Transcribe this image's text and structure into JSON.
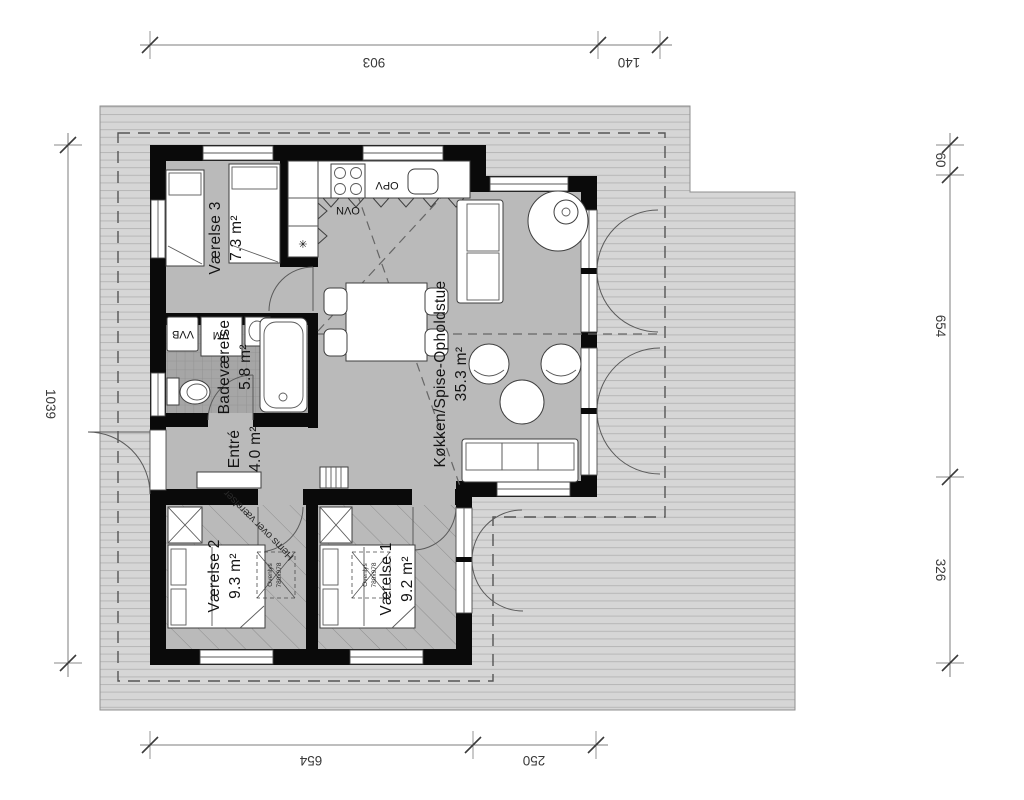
{
  "drawing": {
    "type": "floor-plan",
    "rooms": [
      {
        "name": "Værelse 3",
        "area": "7.3 m²"
      },
      {
        "name": "Badeværelse",
        "area": "5.8 m²"
      },
      {
        "name": "Entré",
        "area": "4.0 m²"
      },
      {
        "name": "Køkken/Spise-Opholdstue",
        "area": "35.3 m²"
      },
      {
        "name": "Værelse 2",
        "area": "9.3 m²"
      },
      {
        "name": "Værelse 1",
        "area": "9.2 m²"
      }
    ],
    "appliances": {
      "oven": "OVN",
      "dishwasher": "OPV",
      "washing_machine": "VM",
      "water_heater": "VVB",
      "star_symbol": "✳"
    },
    "notes": {
      "loft": "Hems over værelser",
      "skylight_label": "Ovenlys",
      "skylight_size": "780x978"
    },
    "dimensions": {
      "top": [
        "903",
        "140"
      ],
      "bottom": [
        "654",
        "250"
      ],
      "left": [
        "1039"
      ],
      "right": [
        "60",
        "654",
        "326"
      ]
    },
    "colors": {
      "wall": "#0a0a0a",
      "floor": "#bababa",
      "deck": "#d6d6d6",
      "deck_line": "#b7b7b7",
      "tile": "#a6a6a6",
      "hatch": "#8e8e8e",
      "background": "#ffffff"
    }
  }
}
